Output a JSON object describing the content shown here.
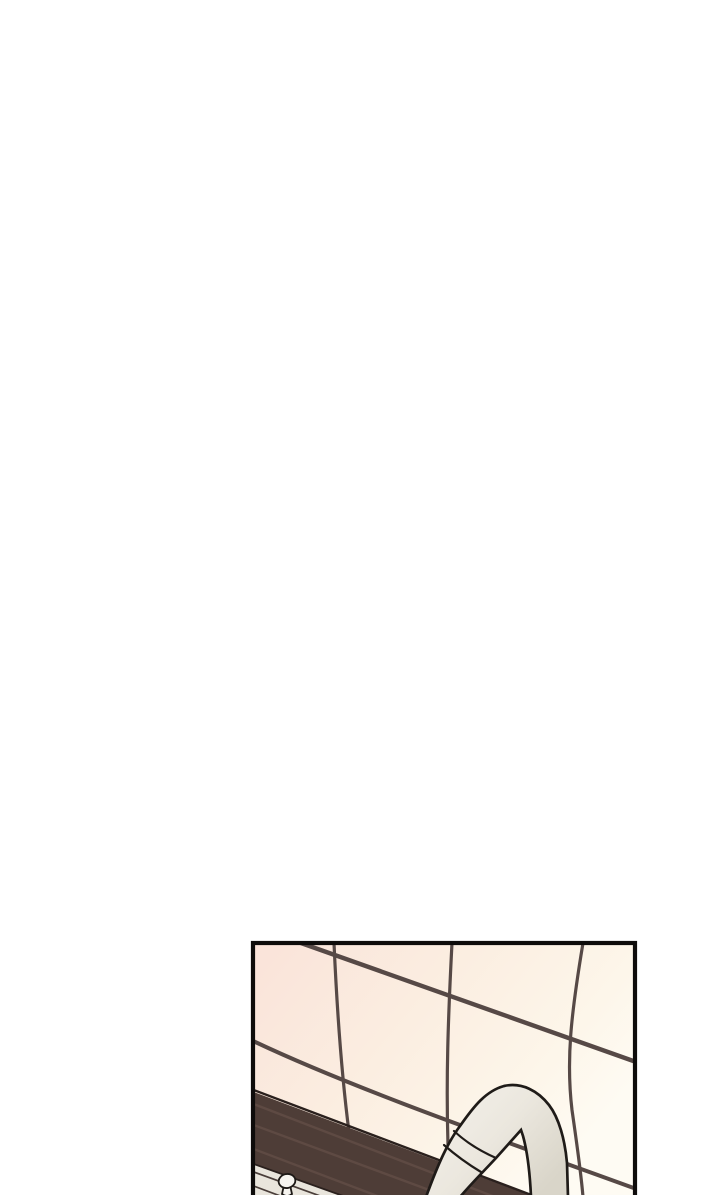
{
  "page": {
    "background": "#ffffff",
    "description": "Blank white webtoon page; a single comic panel enters from the bottom edge and is cropped by the page boundary."
  },
  "panel": {
    "description": "Kitchen close-up: warm pink-to-cream tiled wall with dark grout seen in perspective, a dark brown window-sill ledge sloping down to the right, a pale counter front with a small drawer knob at lower left, and a white gooseneck faucet arching up from the bottom.",
    "border_color": "#0e0c0b",
    "colors": {
      "tile_pink": "#fae3d9",
      "tile_mid": "#fbeee1",
      "tile_cream": "#fdf6ea",
      "tile_light": "#fefbf3",
      "grout": "#564946",
      "sill_band": "#4e3d37",
      "sill_streak": "#5e4a43",
      "sill_outline": "#2a201d",
      "counter": "#e9e5dc",
      "counter_line": "#4a3e3a",
      "faucet_light": "#f5f2ec",
      "faucet_mid": "#ebe7de",
      "faucet_shade": "#d9d5c9",
      "faucet_outline": "#1f1b18",
      "knob_fill": "#f6f4ef"
    }
  }
}
